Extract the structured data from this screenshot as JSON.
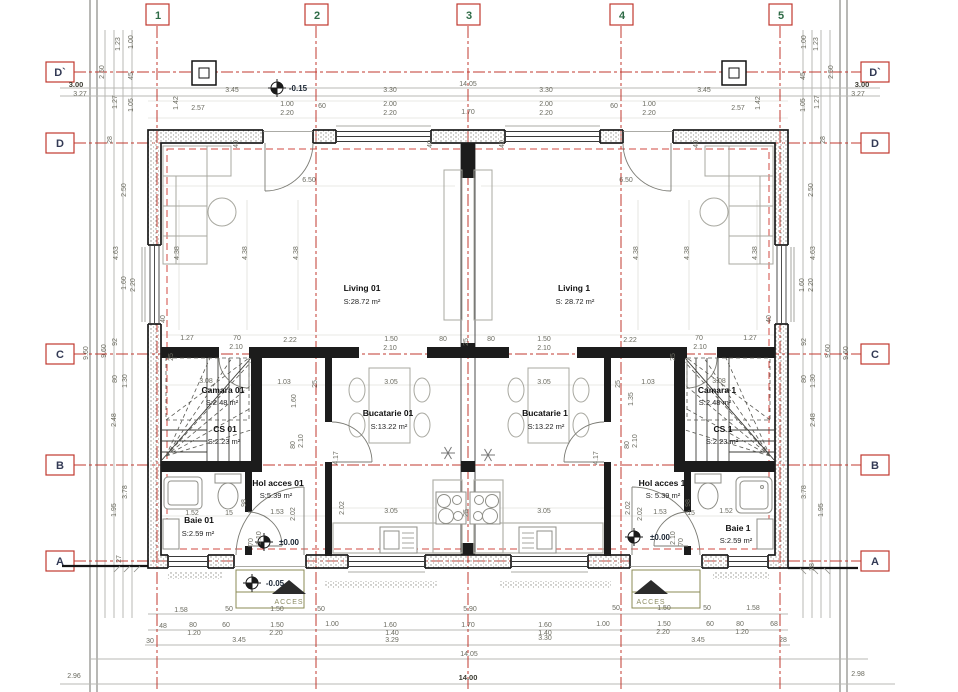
{
  "drawing": {
    "type": "architectural-floor-plan",
    "overall_width": "14.00",
    "overall_depth": "9.60"
  },
  "grid": {
    "columns": [
      "1",
      "2",
      "3",
      "4",
      "5"
    ],
    "rows": [
      "D`",
      "D",
      "C",
      "B",
      "A"
    ]
  },
  "rooms": [
    {
      "name": "Living 01",
      "area": "S:28.72 m²"
    },
    {
      "name": "Living 1",
      "area": "S: 28.72 m²"
    },
    {
      "name": "Bucatarie 01",
      "area": "S:13.22 m²"
    },
    {
      "name": "Bucatarie 1",
      "area": "S:13.22 m²"
    },
    {
      "name": "Camara 01",
      "area": "S:2.48 m²"
    },
    {
      "name": "Camara 1",
      "area": "S:2.48 m²"
    },
    {
      "name": "CS 01",
      "area": "S:2.23 m²"
    },
    {
      "name": "CS 1",
      "area": "S:2.23 m²"
    },
    {
      "name": "Hol acces 01",
      "area": "S:5.39 m²"
    },
    {
      "name": "Hol acces 1",
      "area": "S: 5.39 m²"
    },
    {
      "name": "Baie 01",
      "area": "S:2.59 m²"
    },
    {
      "name": "Baie 1",
      "area": "S:2.59 m²"
    }
  ],
  "levels": [
    "-0.15",
    "±0.00",
    "-0.05"
  ],
  "access_label": "ACCES",
  "colors": {
    "grid_red": "#c0392f",
    "dim_text": "#6b6b60",
    "wall": "#1b1b1b",
    "accent_green": "#2e6b46"
  },
  "annotations": [
    {
      "t": "1",
      "x": 158,
      "y": 19,
      "c": "gc"
    },
    {
      "t": "2",
      "x": 317,
      "y": 19,
      "c": "gc"
    },
    {
      "t": "3",
      "x": 469,
      "y": 19,
      "c": "gc"
    },
    {
      "t": "4",
      "x": 622,
      "y": 19,
      "c": "gc"
    },
    {
      "t": "5",
      "x": 781,
      "y": 19,
      "c": "gc"
    },
    {
      "t": "D`",
      "x": 60,
      "y": 76,
      "c": "gr"
    },
    {
      "t": "D",
      "x": 60,
      "y": 147,
      "c": "gr"
    },
    {
      "t": "C",
      "x": 60,
      "y": 358,
      "c": "gr"
    },
    {
      "t": "B",
      "x": 60,
      "y": 469,
      "c": "gr"
    },
    {
      "t": "A",
      "x": 60,
      "y": 565,
      "c": "gr"
    },
    {
      "t": "D`",
      "x": 875,
      "y": 76,
      "c": "gr"
    },
    {
      "t": "D",
      "x": 875,
      "y": 147,
      "c": "gr"
    },
    {
      "t": "C",
      "x": 875,
      "y": 358,
      "c": "gr"
    },
    {
      "t": "B",
      "x": 875,
      "y": 469,
      "c": "gr"
    },
    {
      "t": "A",
      "x": 875,
      "y": 565,
      "c": "gr"
    },
    {
      "t": "Living 01",
      "x": 362,
      "y": 291,
      "c": "rn"
    },
    {
      "t": "S:28.72 m²",
      "x": 362,
      "y": 304,
      "c": "ra"
    },
    {
      "t": "Living 1",
      "x": 574,
      "y": 291,
      "c": "rn"
    },
    {
      "t": "S: 28.72 m²",
      "x": 575,
      "y": 304,
      "c": "ra"
    },
    {
      "t": "Bucatarie 01",
      "x": 388,
      "y": 416,
      "c": "rn"
    },
    {
      "t": "S:13.22 m²",
      "x": 389,
      "y": 429,
      "c": "ra"
    },
    {
      "t": "Bucatarie 1",
      "x": 545,
      "y": 416,
      "c": "rn"
    },
    {
      "t": "S:13.22 m²",
      "x": 546,
      "y": 429,
      "c": "ra"
    },
    {
      "t": "Camara 01",
      "x": 223,
      "y": 393,
      "c": "rn"
    },
    {
      "t": "S:2.48 m²",
      "x": 222,
      "y": 405,
      "c": "ra"
    },
    {
      "t": "Camara 1",
      "x": 717,
      "y": 393,
      "c": "rn"
    },
    {
      "t": "S:2.48 m²",
      "x": 715,
      "y": 405,
      "c": "ra"
    },
    {
      "t": "CS 01",
      "x": 225,
      "y": 432,
      "c": "rn"
    },
    {
      "t": "S:2.23 m²",
      "x": 224,
      "y": 444,
      "c": "ra"
    },
    {
      "t": "CS 1",
      "x": 723,
      "y": 432,
      "c": "rn"
    },
    {
      "t": "S:2.23 m²",
      "x": 722,
      "y": 444,
      "c": "ra"
    },
    {
      "t": "Hol acces 01",
      "x": 278,
      "y": 486,
      "c": "rn"
    },
    {
      "t": "S:5.39 m²",
      "x": 276,
      "y": 498,
      "c": "ra"
    },
    {
      "t": "Hol acces 1",
      "x": 662,
      "y": 486,
      "c": "rn"
    },
    {
      "t": "S: 5.39 m²",
      "x": 663,
      "y": 498,
      "c": "ra"
    },
    {
      "t": "Baie 01",
      "x": 199,
      "y": 523,
      "c": "rn"
    },
    {
      "t": "S:2.59 m²",
      "x": 198,
      "y": 536,
      "c": "ra"
    },
    {
      "t": "Baie 1",
      "x": 738,
      "y": 531,
      "c": "rn"
    },
    {
      "t": "S:2.59 m²",
      "x": 736,
      "y": 543,
      "c": "ra"
    },
    {
      "t": "-0.15",
      "x": 298,
      "y": 91,
      "c": "lv"
    },
    {
      "t": "±0.00",
      "x": 289,
      "y": 545,
      "c": "lv"
    },
    {
      "t": "±0.00",
      "x": 660,
      "y": 540,
      "c": "lv"
    },
    {
      "t": "-0.05",
      "x": 275,
      "y": 586,
      "c": "lv"
    },
    {
      "t": "ACCES",
      "x": 289,
      "y": 604,
      "c": "ac"
    },
    {
      "t": "ACCES",
      "x": 651,
      "y": 604,
      "c": "ac"
    },
    {
      "t": "3.00",
      "x": 76,
      "y": 87,
      "c": "b"
    },
    {
      "t": "3.27",
      "x": 80,
      "y": 96
    },
    {
      "t": "3.45",
      "x": 232,
      "y": 92
    },
    {
      "t": "3.30",
      "x": 390,
      "y": 92
    },
    {
      "t": "14.05",
      "x": 468,
      "y": 86
    },
    {
      "t": "3.30",
      "x": 546,
      "y": 92
    },
    {
      "t": "3.45",
      "x": 704,
      "y": 92
    },
    {
      "t": "3.00",
      "x": 862,
      "y": 87,
      "c": "b"
    },
    {
      "t": "3.27",
      "x": 858,
      "y": 96
    },
    {
      "t": "2.57",
      "x": 198,
      "y": 110
    },
    {
      "t": "1.00",
      "x": 287,
      "y": 106
    },
    {
      "t": "2.20",
      "x": 287,
      "y": 115
    },
    {
      "t": "60",
      "x": 322,
      "y": 108
    },
    {
      "t": "2.00",
      "x": 390,
      "y": 106
    },
    {
      "t": "2.20",
      "x": 390,
      "y": 115
    },
    {
      "t": "1.70",
      "x": 468,
      "y": 114
    },
    {
      "t": "2.00",
      "x": 546,
      "y": 106
    },
    {
      "t": "2.20",
      "x": 546,
      "y": 115
    },
    {
      "t": "60",
      "x": 614,
      "y": 108
    },
    {
      "t": "1.00",
      "x": 649,
      "y": 106
    },
    {
      "t": "2.20",
      "x": 649,
      "y": 115
    },
    {
      "t": "2.57",
      "x": 738,
      "y": 110
    },
    {
      "t": "1.00",
      "x": 133,
      "y": 42,
      "r": 90
    },
    {
      "t": "1.23",
      "x": 120,
      "y": 44,
      "r": 90
    },
    {
      "t": "2.50",
      "x": 104,
      "y": 72,
      "r": 90
    },
    {
      "t": "45",
      "x": 133,
      "y": 76,
      "r": 90
    },
    {
      "t": "1.27",
      "x": 117,
      "y": 102,
      "r": 90
    },
    {
      "t": "1.05",
      "x": 133,
      "y": 105,
      "r": 90
    },
    {
      "t": "1.42",
      "x": 178,
      "y": 103,
      "r": 90
    },
    {
      "t": "28",
      "x": 112,
      "y": 140,
      "r": 90
    },
    {
      "t": "2.50",
      "x": 126,
      "y": 190,
      "r": 90
    },
    {
      "t": "1.00",
      "x": 806,
      "y": 42,
      "r": 90
    },
    {
      "t": "1.23",
      "x": 818,
      "y": 44,
      "r": 90
    },
    {
      "t": "2.50",
      "x": 833,
      "y": 72,
      "r": 90
    },
    {
      "t": "45",
      "x": 805,
      "y": 76,
      "r": 90
    },
    {
      "t": "1.05",
      "x": 805,
      "y": 105,
      "r": 90
    },
    {
      "t": "1.27",
      "x": 819,
      "y": 102,
      "r": 90
    },
    {
      "t": "1.42",
      "x": 760,
      "y": 103,
      "r": 90
    },
    {
      "t": "28",
      "x": 825,
      "y": 140,
      "r": 90
    },
    {
      "t": "2.50",
      "x": 813,
      "y": 190,
      "r": 90
    },
    {
      "t": "4.63",
      "x": 118,
      "y": 253,
      "r": 90
    },
    {
      "t": "1.60",
      "x": 126,
      "y": 283,
      "r": 90
    },
    {
      "t": "2.20",
      "x": 135,
      "y": 285,
      "r": 90
    },
    {
      "t": "92",
      "x": 117,
      "y": 342,
      "r": 90
    },
    {
      "t": "9.60",
      "x": 88,
      "y": 353,
      "r": 90
    },
    {
      "t": "9.60",
      "x": 106,
      "y": 351,
      "r": 90
    },
    {
      "t": "80",
      "x": 117,
      "y": 379,
      "r": 90
    },
    {
      "t": "1.30",
      "x": 127,
      "y": 381,
      "r": 90
    },
    {
      "t": "2.48",
      "x": 116,
      "y": 420,
      "r": 90
    },
    {
      "t": "3.78",
      "x": 127,
      "y": 492,
      "r": 90
    },
    {
      "t": "1.95",
      "x": 116,
      "y": 510,
      "r": 90
    },
    {
      "t": "27",
      "x": 121,
      "y": 559,
      "r": 90
    },
    {
      "t": "2.96",
      "x": 74,
      "y": 678
    },
    {
      "t": "4.63",
      "x": 815,
      "y": 253,
      "r": 90
    },
    {
      "t": "1.60",
      "x": 804,
      "y": 285,
      "r": 90
    },
    {
      "t": "2.20",
      "x": 813,
      "y": 285,
      "r": 90
    },
    {
      "t": "92",
      "x": 806,
      "y": 342,
      "r": 90
    },
    {
      "t": "9.60",
      "x": 848,
      "y": 353,
      "r": 90
    },
    {
      "t": "9.60",
      "x": 830,
      "y": 351,
      "r": 90
    },
    {
      "t": "80",
      "x": 806,
      "y": 379,
      "r": 90
    },
    {
      "t": "1.30",
      "x": 815,
      "y": 381,
      "r": 90
    },
    {
      "t": "2.48",
      "x": 815,
      "y": 420,
      "r": 90
    },
    {
      "t": "3.78",
      "x": 806,
      "y": 492,
      "r": 90
    },
    {
      "t": "1.95",
      "x": 823,
      "y": 510,
      "r": 90
    },
    {
      "t": "28",
      "x": 814,
      "y": 567,
      "r": 90
    },
    {
      "t": "2.98",
      "x": 858,
      "y": 676
    },
    {
      "t": "6.50",
      "x": 309,
      "y": 182
    },
    {
      "t": "6.50",
      "x": 626,
      "y": 182
    },
    {
      "t": "4.38",
      "x": 179,
      "y": 253,
      "r": 90
    },
    {
      "t": "4.38",
      "x": 247,
      "y": 253,
      "r": 90
    },
    {
      "t": "4.38",
      "x": 298,
      "y": 253,
      "r": 90
    },
    {
      "t": "4.38",
      "x": 638,
      "y": 253,
      "r": 90
    },
    {
      "t": "4.38",
      "x": 689,
      "y": 253,
      "r": 90
    },
    {
      "t": "4.38",
      "x": 757,
      "y": 253,
      "r": 90
    },
    {
      "t": "40",
      "x": 238,
      "y": 144,
      "r": 90
    },
    {
      "t": "40",
      "x": 432,
      "y": 144,
      "r": 90
    },
    {
      "t": "40",
      "x": 504,
      "y": 144,
      "r": 90
    },
    {
      "t": "40",
      "x": 698,
      "y": 144,
      "r": 90
    },
    {
      "t": "40",
      "x": 165,
      "y": 319,
      "r": 90
    },
    {
      "t": "40",
      "x": 771,
      "y": 319,
      "r": 90
    },
    {
      "t": "1.27",
      "x": 187,
      "y": 340
    },
    {
      "t": "70",
      "x": 237,
      "y": 340
    },
    {
      "t": "2.10",
      "x": 236,
      "y": 349
    },
    {
      "t": "2.22",
      "x": 290,
      "y": 342
    },
    {
      "t": "1.50",
      "x": 391,
      "y": 341
    },
    {
      "t": "2.10",
      "x": 390,
      "y": 350
    },
    {
      "t": "80",
      "x": 443,
      "y": 341
    },
    {
      "t": "25",
      "x": 468,
      "y": 342,
      "r": 90
    },
    {
      "t": "80",
      "x": 491,
      "y": 341
    },
    {
      "t": "1.50",
      "x": 544,
      "y": 341
    },
    {
      "t": "2.10",
      "x": 544,
      "y": 350
    },
    {
      "t": "2.22",
      "x": 630,
      "y": 342
    },
    {
      "t": "70",
      "x": 699,
      "y": 340
    },
    {
      "t": "2.10",
      "x": 700,
      "y": 349
    },
    {
      "t": "1.27",
      "x": 750,
      "y": 340
    },
    {
      "t": "25",
      "x": 173,
      "y": 357,
      "r": 90
    },
    {
      "t": "25",
      "x": 675,
      "y": 357,
      "r": 90
    },
    {
      "t": "3.08",
      "x": 206,
      "y": 383
    },
    {
      "t": "1.03",
      "x": 284,
      "y": 384
    },
    {
      "t": "25",
      "x": 317,
      "y": 384,
      "r": 90
    },
    {
      "t": "3.05",
      "x": 391,
      "y": 384
    },
    {
      "t": "3.05",
      "x": 544,
      "y": 384
    },
    {
      "t": "25",
      "x": 620,
      "y": 384,
      "r": 90
    },
    {
      "t": "1.03",
      "x": 648,
      "y": 384
    },
    {
      "t": "3.08",
      "x": 719,
      "y": 383
    },
    {
      "t": "1.60",
      "x": 296,
      "y": 401,
      "r": 90
    },
    {
      "t": "1.35",
      "x": 633,
      "y": 399,
      "r": 90
    },
    {
      "t": "80",
      "x": 295,
      "y": 445,
      "r": 90
    },
    {
      "t": "2.10",
      "x": 303,
      "y": 441,
      "r": 90
    },
    {
      "t": "80",
      "x": 629,
      "y": 445,
      "r": 90
    },
    {
      "t": "2.10",
      "x": 637,
      "y": 441,
      "r": 90
    },
    {
      "t": "4.17",
      "x": 338,
      "y": 458,
      "r": 90
    },
    {
      "t": "4.17",
      "x": 598,
      "y": 458,
      "r": 90
    },
    {
      "t": "3.05",
      "x": 391,
      "y": 513
    },
    {
      "t": "25",
      "x": 468,
      "y": 513,
      "r": 90
    },
    {
      "t": "3.05",
      "x": 544,
      "y": 513
    },
    {
      "t": "2.02",
      "x": 344,
      "y": 508,
      "r": 90
    },
    {
      "t": "2.02",
      "x": 630,
      "y": 508,
      "r": 90
    },
    {
      "t": "1.52",
      "x": 192,
      "y": 515
    },
    {
      "t": "15",
      "x": 229,
      "y": 515
    },
    {
      "t": "1.53",
      "x": 277,
      "y": 514
    },
    {
      "t": "2.02",
      "x": 295,
      "y": 514,
      "r": 90
    },
    {
      "t": "98",
      "x": 246,
      "y": 503,
      "r": 90
    },
    {
      "t": "70",
      "x": 253,
      "y": 542,
      "r": 90
    },
    {
      "t": "2.10",
      "x": 261,
      "y": 538,
      "r": 90
    },
    {
      "t": "1.53",
      "x": 660,
      "y": 514
    },
    {
      "t": "15",
      "x": 691,
      "y": 515
    },
    {
      "t": "1.52",
      "x": 726,
      "y": 513
    },
    {
      "t": "2.02",
      "x": 642,
      "y": 514,
      "r": 90
    },
    {
      "t": "98",
      "x": 690,
      "y": 503,
      "r": 90
    },
    {
      "t": "70",
      "x": 683,
      "y": 542,
      "r": 90
    },
    {
      "t": "2.10",
      "x": 675,
      "y": 538,
      "r": 90
    },
    {
      "t": "1.58",
      "x": 181,
      "y": 612
    },
    {
      "t": "50",
      "x": 229,
      "y": 611
    },
    {
      "t": "1.50",
      "x": 277,
      "y": 611
    },
    {
      "t": "50",
      "x": 321,
      "y": 611
    },
    {
      "t": "5.90",
      "x": 470,
      "y": 611
    },
    {
      "t": "50",
      "x": 616,
      "y": 610
    },
    {
      "t": "1.50",
      "x": 664,
      "y": 610
    },
    {
      "t": "50",
      "x": 707,
      "y": 610
    },
    {
      "t": "1.58",
      "x": 753,
      "y": 610
    },
    {
      "t": "48",
      "x": 163,
      "y": 628
    },
    {
      "t": "80",
      "x": 193,
      "y": 627
    },
    {
      "t": "1.20",
      "x": 194,
      "y": 635
    },
    {
      "t": "60",
      "x": 226,
      "y": 627
    },
    {
      "t": "1.50",
      "x": 277,
      "y": 627
    },
    {
      "t": "2.20",
      "x": 276,
      "y": 635
    },
    {
      "t": "1.00",
      "x": 332,
      "y": 626
    },
    {
      "t": "1.60",
      "x": 390,
      "y": 627
    },
    {
      "t": "1.40",
      "x": 392,
      "y": 635
    },
    {
      "t": "1.70",
      "x": 468,
      "y": 627
    },
    {
      "t": "1.60",
      "x": 545,
      "y": 627
    },
    {
      "t": "1.40",
      "x": 545,
      "y": 635
    },
    {
      "t": "1.00",
      "x": 603,
      "y": 626
    },
    {
      "t": "1.50",
      "x": 664,
      "y": 626
    },
    {
      "t": "2.20",
      "x": 663,
      "y": 634
    },
    {
      "t": "60",
      "x": 710,
      "y": 626
    },
    {
      "t": "80",
      "x": 740,
      "y": 626
    },
    {
      "t": "1.20",
      "x": 742,
      "y": 634
    },
    {
      "t": "68",
      "x": 774,
      "y": 626
    },
    {
      "t": "30",
      "x": 150,
      "y": 643
    },
    {
      "t": "3.45",
      "x": 239,
      "y": 642
    },
    {
      "t": "3.29",
      "x": 392,
      "y": 642
    },
    {
      "t": "3.30",
      "x": 545,
      "y": 640
    },
    {
      "t": "3.45",
      "x": 698,
      "y": 642
    },
    {
      "t": "28",
      "x": 783,
      "y": 642
    },
    {
      "t": "14.05",
      "x": 469,
      "y": 656
    },
    {
      "t": "14.00",
      "x": 468,
      "y": 680,
      "c": "b"
    }
  ]
}
